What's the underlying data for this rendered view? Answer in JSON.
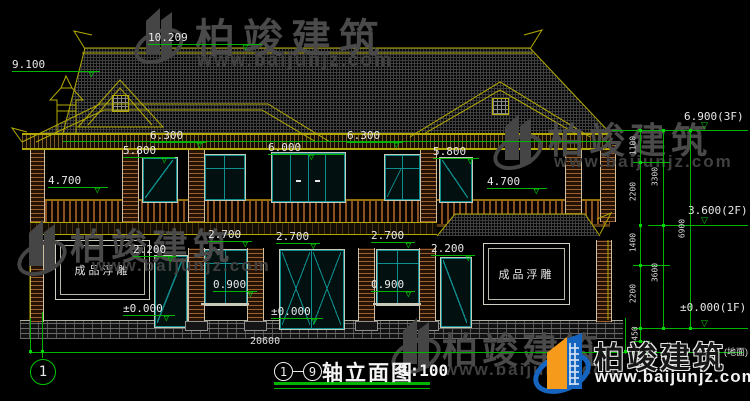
{
  "watermark": {
    "brand": "柏竣建筑",
    "site": "www.baijunjz.com"
  },
  "logo": {
    "brand": "柏竣建筑",
    "site": "www.baijunjz.com"
  },
  "title_block": {
    "axis_start": "1",
    "axis_end": "9",
    "separator": "－",
    "title": "轴立面图",
    "scale": "1:100"
  },
  "axis_bubble": "1",
  "ground_note": "(地面)",
  "panels": {
    "left": "成品浮雕",
    "right": "成品浮雕"
  },
  "dims": {
    "ridge": "10.209",
    "chimney": "9.100",
    "eave_left": "6.300",
    "eave_right": "6.300",
    "door2f_left": "5.800",
    "balcony_door": "6.000",
    "door2f_right": "5.800",
    "balcony_left": "4.700",
    "balcony_right": "4.700",
    "level_3f": "6.900(3F)",
    "level_2f": "3.600(2F)",
    "level_1f": "±0.000(1F)",
    "door1f_left": "2.200",
    "win1f_a": "2.700",
    "win1f_b": "2.700",
    "win1f_c": "2.700",
    "door1f_right": "2.200",
    "sill_left": "0.900",
    "sill_right": "0.900",
    "ground_left": "±0.000",
    "ground_center": "±0.000",
    "overall_width": "20600",
    "seg_1100": "1100",
    "seg_2200_upper": "2200",
    "seg_1400": "1400",
    "seg_2200_lower": "2200",
    "seg_450": "450",
    "sub_3300": "3300",
    "sub_3600": "3600",
    "total_6900": "6900"
  },
  "colors": {
    "background": "#000000",
    "dimension_green": "#00b400",
    "outline_yellow": "#b4aa00",
    "window_teal": "#0f8f8f",
    "dim_text": "#e8e8e8",
    "watermark_gray": "#4a4a4a",
    "logo_blue": "#1565c0",
    "logo_orange": "#f59a1a"
  }
}
